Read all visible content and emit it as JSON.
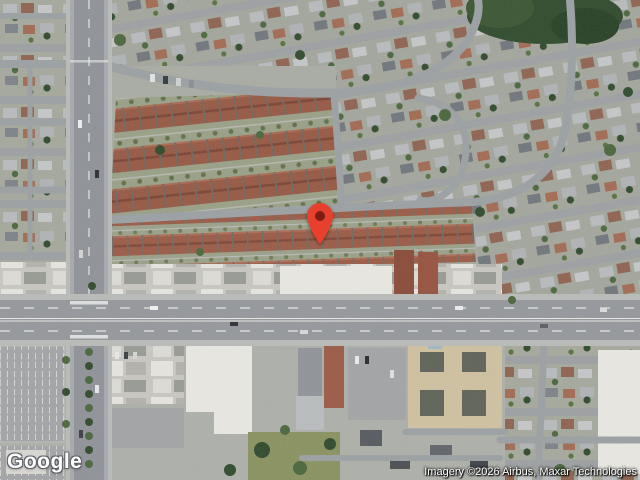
{
  "map": {
    "view_type": "satellite",
    "logo_text": "Google",
    "attribution_text": "Imagery ©2026 Airbus, Maxar Technologies",
    "marker": {
      "x": 320,
      "y": 246,
      "label": "dropped-pin"
    }
  },
  "colors": {
    "base": "#a9aca3",
    "grass": "#89925f",
    "tree": "#4a663c",
    "treeDark": "#2f4a2c",
    "road": "#94979b",
    "roadMajor": "#8f9399",
    "roadMinor": "#9ba0a3",
    "laneLine": "#e6e7e4",
    "sidewalk": "#b9bbb8",
    "parking": "#a2a4a6",
    "white_bldg": "#e9e8e2",
    "tan_bldg": "#cfc1a0",
    "courtyard": "#5e6257",
    "roofRed": "#9a5a45",
    "roofRedDark": "#7e4636",
    "markerRed": "#E8402F",
    "markerInner": "#7E1D10"
  }
}
